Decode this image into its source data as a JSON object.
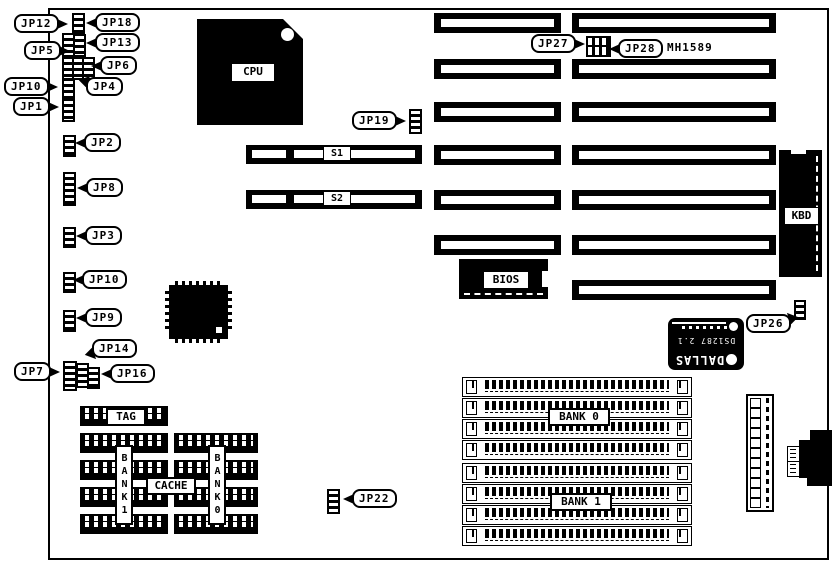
{
  "colors": {
    "foreground": "#000000",
    "background": "#ffffff"
  },
  "callouts": {
    "jp12": "JP12",
    "jp18": "JP18",
    "jp13": "JP13",
    "jp5": "JP5",
    "jp6": "JP6",
    "jp4": "JP4",
    "jp10_top": "JP10",
    "jp1": "JP1",
    "jp2": "JP2",
    "jp8": "JP8",
    "jp3": "JP3",
    "jp10_mid": "JP10",
    "jp9": "JP9",
    "jp14": "JP14",
    "jp7": "JP7",
    "jp16": "JP16",
    "jp19": "JP19",
    "jp27": "JP27",
    "jp28": "JP28",
    "jp26": "JP26",
    "jp22": "JP22"
  },
  "labels": {
    "cpu": "CPU",
    "bios": "BIOS",
    "kbd": "KBD",
    "tag": "TAG",
    "cache": "CACHE",
    "bank0": "BANK 0",
    "bank1": "BANK 1",
    "bank0_vertical": "BANK0",
    "bank1_vertical": "BANK1",
    "s1": "S1",
    "s2": "S2",
    "mh1589": "MH1589",
    "dallas_line1": "DALLAS",
    "dallas_line2": "DS1287 2.1"
  }
}
